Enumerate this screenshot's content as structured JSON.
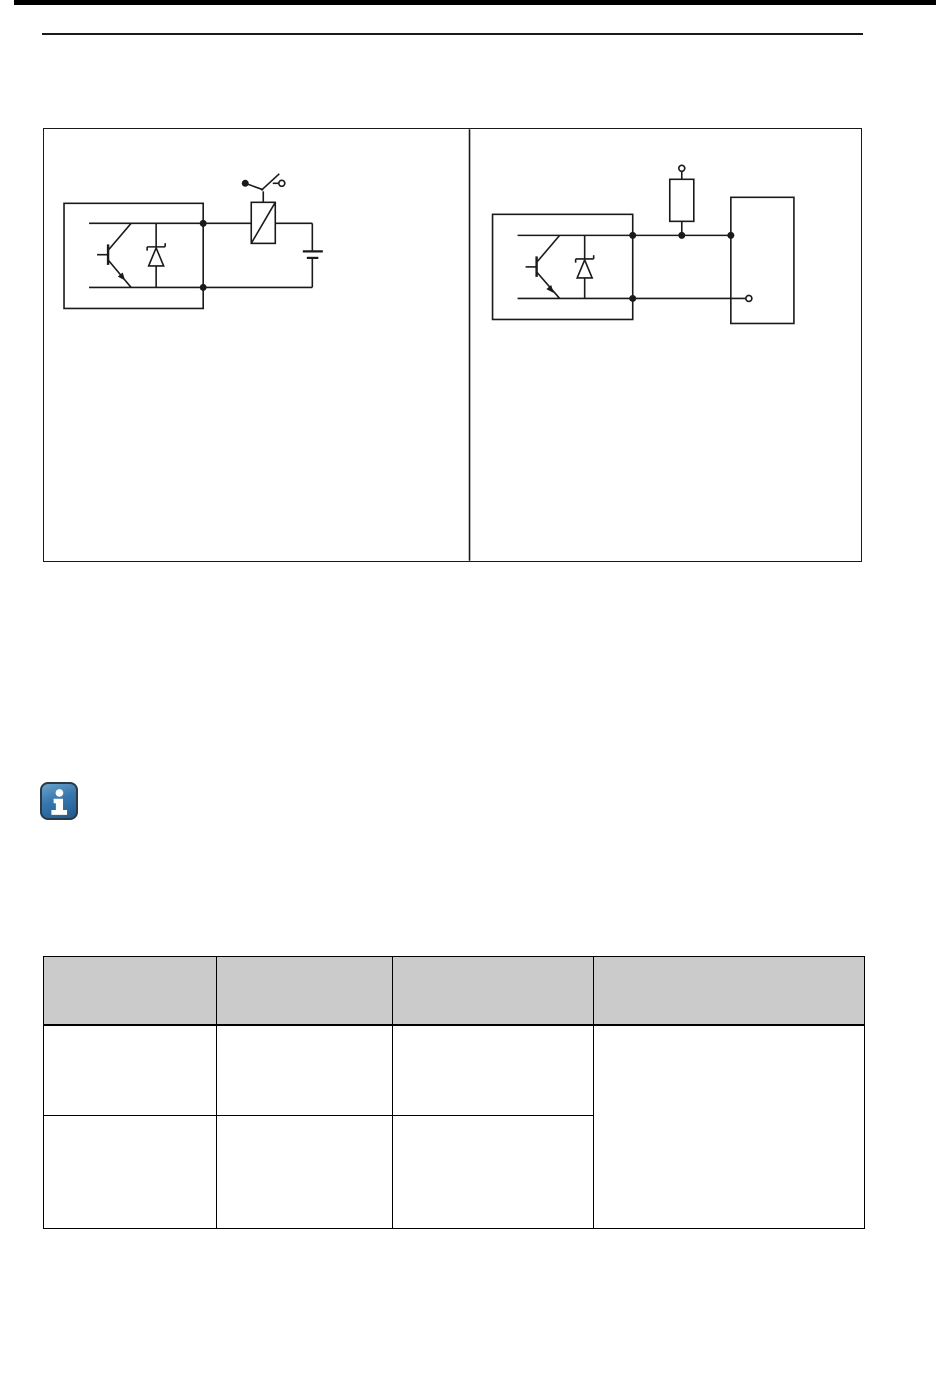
{
  "page": {
    "kind": "manual-page",
    "background": "#ffffff",
    "top_bar_color": "#000000",
    "rule_color": "#1a1a1a"
  },
  "colors": {
    "circuit_line": "#1a1a1a",
    "table_border": "#000000",
    "table_header_bg": "#cbcbcb",
    "info_icon_blue": "#3877ad",
    "info_icon_border": "#2b3a45",
    "info_icon_glyph": "#ffffff"
  },
  "icons": {
    "info": "info-icon"
  },
  "figure": {
    "panel_count": 2,
    "left_panel_caption": "",
    "right_panel_caption": ""
  },
  "note": {
    "text": ""
  },
  "table": {
    "headers": [
      "",
      "",
      "",
      ""
    ],
    "rows": [
      {
        "cells": [
          "",
          "",
          ""
        ],
        "span_cell": ""
      },
      {
        "cells": [
          "",
          "",
          ""
        ]
      }
    ]
  }
}
